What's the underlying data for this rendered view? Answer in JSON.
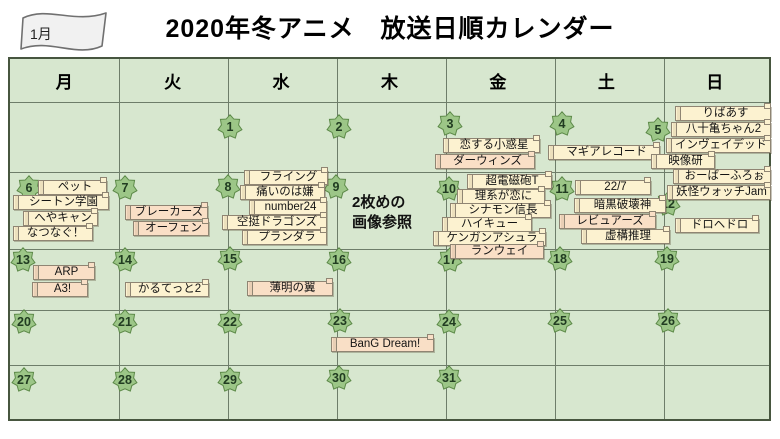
{
  "page": {
    "month_flag": "1月",
    "title": "2020年冬アニメ　放送日順カレンダー"
  },
  "weekdays": [
    "月",
    "火",
    "水",
    "木",
    "金",
    "土",
    "日"
  ],
  "days": [
    "1",
    "2",
    "3",
    "4",
    "5",
    "6",
    "7",
    "8",
    "9",
    "10",
    "11",
    "12",
    "13",
    "14",
    "15",
    "16",
    "17",
    "18",
    "19",
    "20",
    "21",
    "22",
    "23",
    "24",
    "25",
    "26",
    "27",
    "28",
    "29",
    "30",
    "31"
  ],
  "note": {
    "line1": "2枚めの",
    "line2": "画像参照"
  },
  "palette": {
    "cell_green": "#d7e7cf",
    "grid_line": "#6e7d6a",
    "outer_border": "#47563f",
    "star_fill": "#9cc687",
    "star_border": "#5d8a49",
    "box_cream": "#fcf2d0",
    "box_peach": "#f9dfc6",
    "box_border": "#8f8573",
    "flag_fill": "#f1f1f1"
  },
  "titles": [
    {
      "label": "ペット",
      "tone": "cream",
      "day": "6"
    },
    {
      "label": "シートン学園",
      "tone": "cream",
      "day": "6"
    },
    {
      "label": "へやキャン",
      "tone": "cream",
      "day": "6"
    },
    {
      "label": "なつなぐ！",
      "tone": "cream",
      "day": "6"
    },
    {
      "label": "ブレーカーズ",
      "tone": "peach",
      "day": "7"
    },
    {
      "label": "オーフェン",
      "tone": "peach",
      "day": "7"
    },
    {
      "label": "フライング",
      "tone": "cream",
      "day": "8"
    },
    {
      "label": "痛いのは嫌",
      "tone": "cream",
      "day": "8"
    },
    {
      "label": "number24",
      "tone": "cream",
      "day": "8"
    },
    {
      "label": "空挺ドラゴンズ",
      "tone": "cream",
      "day": "8"
    },
    {
      "label": "プランダラ",
      "tone": "cream",
      "day": "8"
    },
    {
      "label": "恋する小惑星",
      "tone": "cream",
      "day": "3"
    },
    {
      "label": "ダーウィンズ",
      "tone": "peach",
      "day": "3"
    },
    {
      "label": "超電磁砲T",
      "tone": "cream",
      "day": "10"
    },
    {
      "label": "理系が恋に",
      "tone": "cream",
      "day": "10"
    },
    {
      "label": "シナモン信長",
      "tone": "cream",
      "day": "10"
    },
    {
      "label": "ハイキュー",
      "tone": "cream",
      "day": "10"
    },
    {
      "label": "ケンガンアシュラ",
      "tone": "cream",
      "day": "10"
    },
    {
      "label": "ランウェイ",
      "tone": "peach",
      "day": "10"
    },
    {
      "label": "マギアレコード",
      "tone": "cream",
      "day": "4"
    },
    {
      "label": "22/7",
      "tone": "cream",
      "day": "11"
    },
    {
      "label": "暗黒破壊神",
      "tone": "cream",
      "day": "11"
    },
    {
      "label": "レビュアーズ",
      "tone": "peach",
      "day": "11"
    },
    {
      "label": "虚構推理",
      "tone": "cream",
      "day": "11"
    },
    {
      "label": "りばあす",
      "tone": "cream",
      "day": "5"
    },
    {
      "label": "八十亀ちゃん2",
      "tone": "cream",
      "day": "5"
    },
    {
      "label": "インヴェイデッド",
      "tone": "cream",
      "day": "5"
    },
    {
      "label": "映像研",
      "tone": "cream",
      "day": "5"
    },
    {
      "label": "おーばーふろぉ",
      "tone": "cream",
      "day": "5"
    },
    {
      "label": "妖怪ウォッチJam",
      "tone": "cream",
      "day": "5"
    },
    {
      "label": "ドロヘドロ",
      "tone": "cream",
      "day": "12"
    },
    {
      "label": "ARP",
      "tone": "peach",
      "day": "13"
    },
    {
      "label": "A3!",
      "tone": "peach",
      "day": "13"
    },
    {
      "label": "かるてっと2",
      "tone": "cream",
      "day": "14"
    },
    {
      "label": "薄明の翼",
      "tone": "peach",
      "day": "15"
    },
    {
      "label": "BanG Dream!",
      "tone": "peach",
      "day": "23"
    }
  ]
}
